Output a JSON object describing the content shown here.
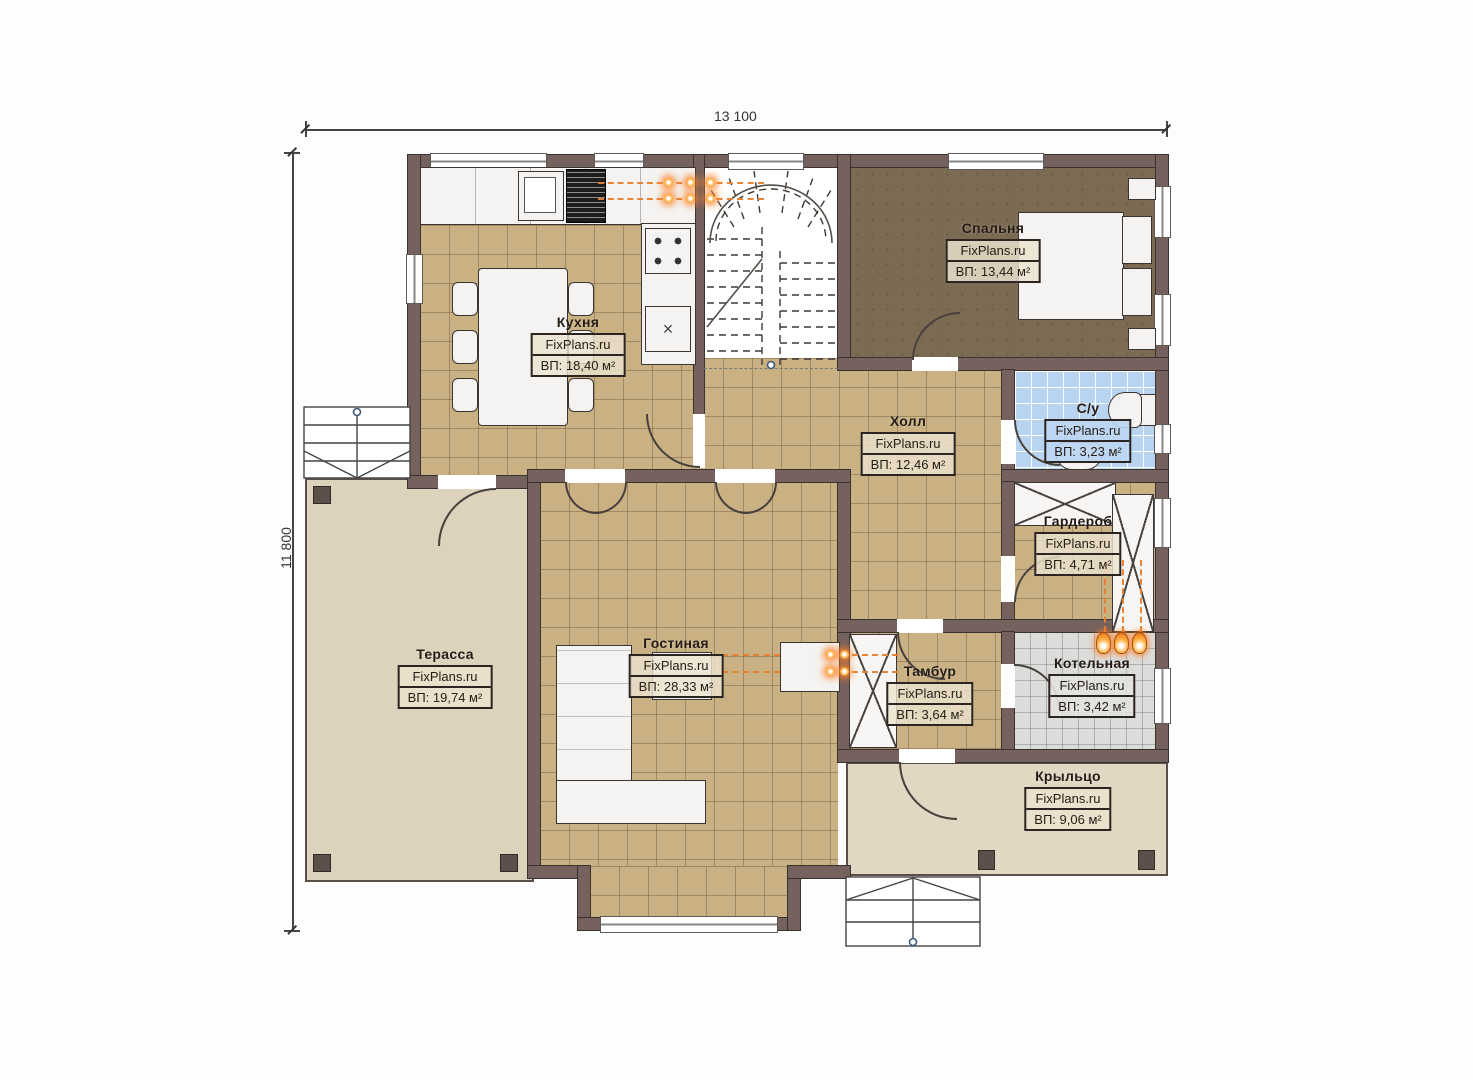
{
  "watermark": "FixPlans.ru",
  "dimensions": {
    "width_label": "13 100",
    "height_label": "11 800"
  },
  "symbols": {
    "cross_box": "×"
  },
  "colors": {
    "wall": "#75615d",
    "floor_tan": "#c9b183",
    "floor_bedroom": "#7c6b53",
    "floor_bath": "#b9d4f1",
    "floor_boiler": "#dcdcda",
    "floor_terrace": "#ddd2bb",
    "floor_porch": "#e2d7c3",
    "radiator_accent": "#f07818"
  },
  "rooms": [
    {
      "id": "kitchen",
      "name": "Кухня",
      "area": "ВП: 18,40 м²"
    },
    {
      "id": "bedroom",
      "name": "Спальня",
      "area": "ВП: 13,44 м²"
    },
    {
      "id": "hall",
      "name": "Холл",
      "area": "ВП: 12,46 м²"
    },
    {
      "id": "bathroom",
      "name": "С/у",
      "area": "ВП: 3,23 м²"
    },
    {
      "id": "wardrobe",
      "name": "Гардероб",
      "area": "ВП: 4,71 м²"
    },
    {
      "id": "living",
      "name": "Гостиная",
      "area": "ВП: 28,33 м²"
    },
    {
      "id": "terrace",
      "name": "Терасса",
      "area": "ВП: 19,74 м²"
    },
    {
      "id": "vestibule",
      "name": "Тамбур",
      "area": "ВП: 3,64 м²"
    },
    {
      "id": "boiler",
      "name": "Котельная",
      "area": "ВП: 3,42 м²"
    },
    {
      "id": "porch",
      "name": "Крыльцо",
      "area": "ВП: 9,06 м²"
    }
  ]
}
